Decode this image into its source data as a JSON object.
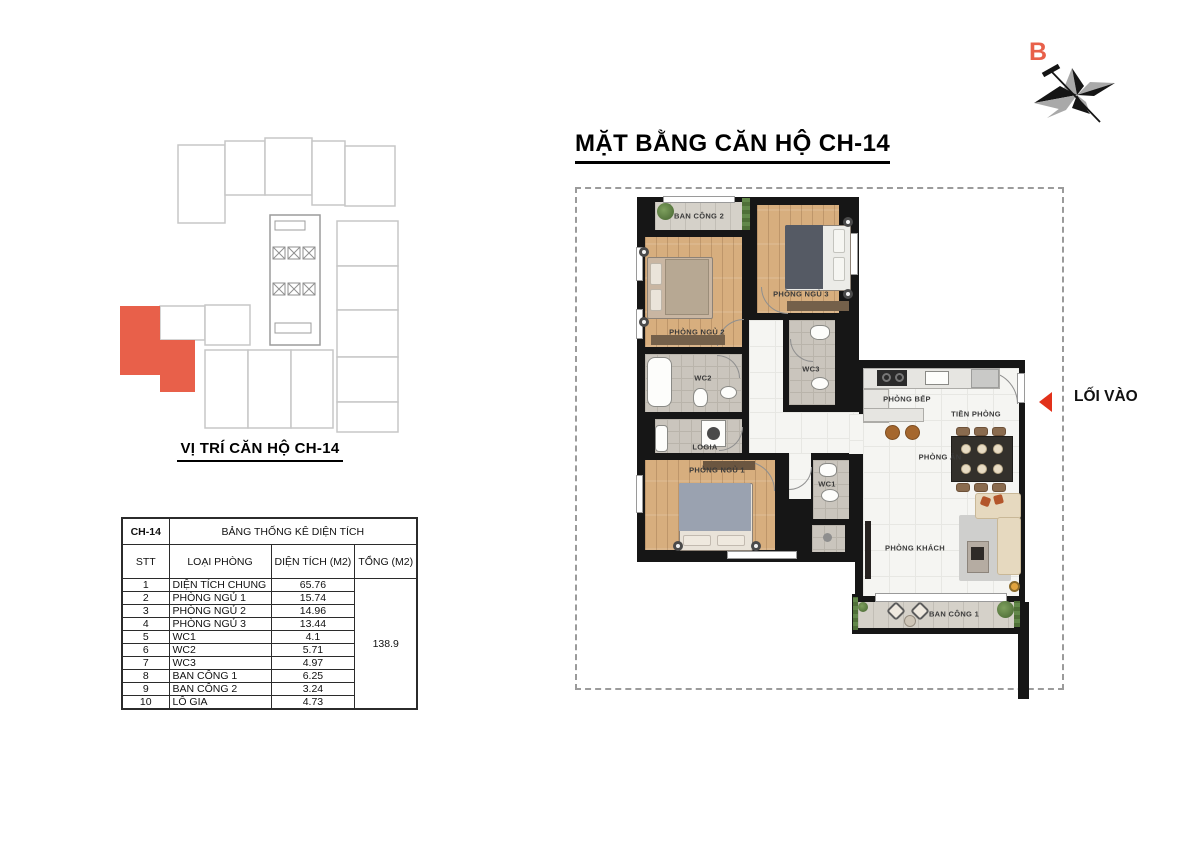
{
  "title": "MẶT BẰNG CĂN HỘ CH-14",
  "compass": {
    "north_label": "B"
  },
  "entrance": {
    "label": "LỐI VÀO"
  },
  "minimap": {
    "caption": "VỊ TRÍ CĂN HỘ CH-14"
  },
  "colors": {
    "highlight_unit": "#E8604A",
    "table_values": "#F01818",
    "entry_arrow": "#E2311A",
    "walls": "#161616"
  },
  "area_table": {
    "unit": "CH-14",
    "title": "BẢNG THỐNG KÊ DIỆN TÍCH",
    "headers": {
      "stt": "STT",
      "room": "LOẠI PHÒNG",
      "area": "DIỆN TÍCH (M2)",
      "total": "TỔNG (M2)"
    },
    "rows": [
      {
        "stt": "1",
        "room": "DIỆN TÍCH CHUNG",
        "area": "65.76"
      },
      {
        "stt": "2",
        "room": "PHÒNG NGỦ 1",
        "area": "15.74"
      },
      {
        "stt": "3",
        "room": "PHÒNG NGỦ 2",
        "area": "14.96"
      },
      {
        "stt": "4",
        "room": "PHÒNG NGỦ 3",
        "area": "13.44"
      },
      {
        "stt": "5",
        "room": "WC1",
        "area": "4.1"
      },
      {
        "stt": "6",
        "room": "WC2",
        "area": "5.71"
      },
      {
        "stt": "7",
        "room": "WC3",
        "area": "4.97"
      },
      {
        "stt": "8",
        "room": "BAN CÔNG 1",
        "area": "6.25"
      },
      {
        "stt": "9",
        "room": "BAN CÔNG 2",
        "area": "3.24"
      },
      {
        "stt": "10",
        "room": "LÔ GIA",
        "area": "4.73"
      }
    ],
    "total": "138.9"
  },
  "plan": {
    "rooms": {
      "balcony2": "BAN CÔNG 2",
      "bedroom3": "PHÒNG NGỦ 3",
      "bedroom2": "PHÒNG NGỦ 2",
      "wc2": "WC2",
      "wc3": "WC3",
      "logia": "LOGIA",
      "kitchen": "PHÒNG BẾP",
      "foyer": "TIỀN PHÒNG",
      "dining": "PHÒNG ĂN",
      "bedroom1": "PHÒNG NGỦ 1",
      "wc1": "WC1",
      "living": "PHÒNG KHÁCH",
      "balcony1": "BAN CÔNG 1"
    }
  }
}
